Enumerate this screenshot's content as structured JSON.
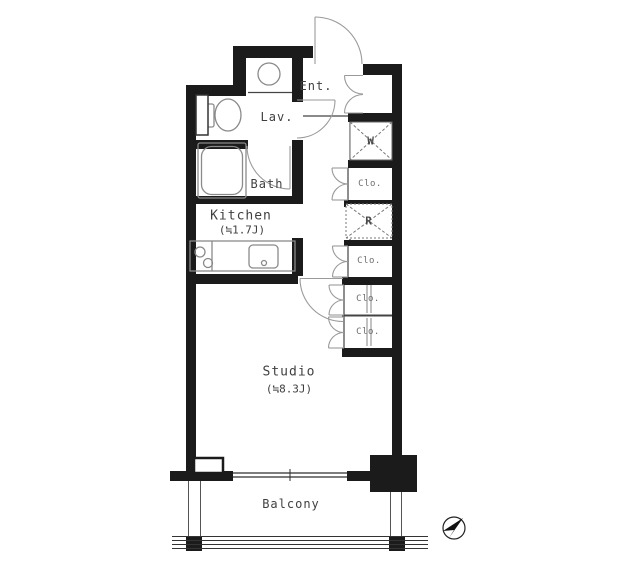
{
  "plan": {
    "rooms": {
      "ent": {
        "label": "Ent."
      },
      "lav": {
        "label": "Lav."
      },
      "bath": {
        "label": "Bath"
      },
      "kitchen": {
        "label": "Kitchen",
        "size": "(≒1.7J)"
      },
      "studio": {
        "label": "Studio",
        "size": "(≒8.3J)"
      },
      "balcony": {
        "label": "Balcony"
      }
    },
    "storage": {
      "washer": {
        "label": "W"
      },
      "fridge": {
        "label": "R"
      },
      "closets": [
        {
          "label": "Clo."
        },
        {
          "label": "Clo."
        },
        {
          "label": "Clo."
        },
        {
          "label": "Clo."
        }
      ]
    },
    "colors": {
      "wall": "#1b1b1b",
      "fixture_line": "#8a8a8a",
      "door_line": "#9a9a9a",
      "thin_line": "#444444",
      "text": "#3f3f3f",
      "closet_text": "#6e6e6e",
      "background": "#ffffff"
    }
  }
}
